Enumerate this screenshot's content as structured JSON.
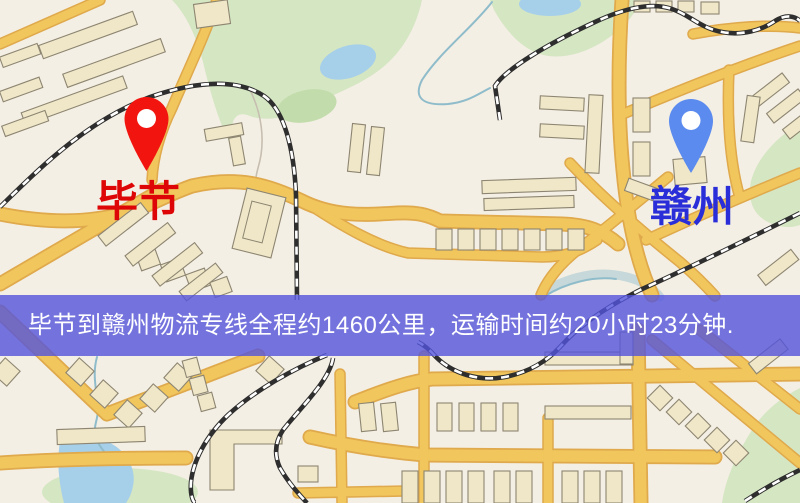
{
  "banner": {
    "text": "毕节到赣州物流专线全程约1460公里，运输时间约20小时23分钟.",
    "background_color": "#5454dc",
    "text_color": "#ffffff"
  },
  "markers": {
    "origin": {
      "label": "毕节",
      "pin": "red-map-pin-icon",
      "pin_color": "#f2150f",
      "label_color": "#dd0505"
    },
    "destination": {
      "label": "赣州",
      "pin": "blue-map-pin-icon",
      "pin_color": "#5b8bee",
      "label_color": "#2a2ed8"
    }
  },
  "map_colors": {
    "background": "#f4efe4",
    "road_fill": "#f0c65d",
    "road_border": "#dfa94c",
    "building_fill": "#efe7c8",
    "building_border": "#8d8571",
    "park": "#d5e6c3",
    "park_dark": "#c2dcab",
    "water": "#a6cfe9",
    "railway": "#2e2e2e",
    "stream": "#8fbccb",
    "banner_overlay": "#5454dc"
  }
}
